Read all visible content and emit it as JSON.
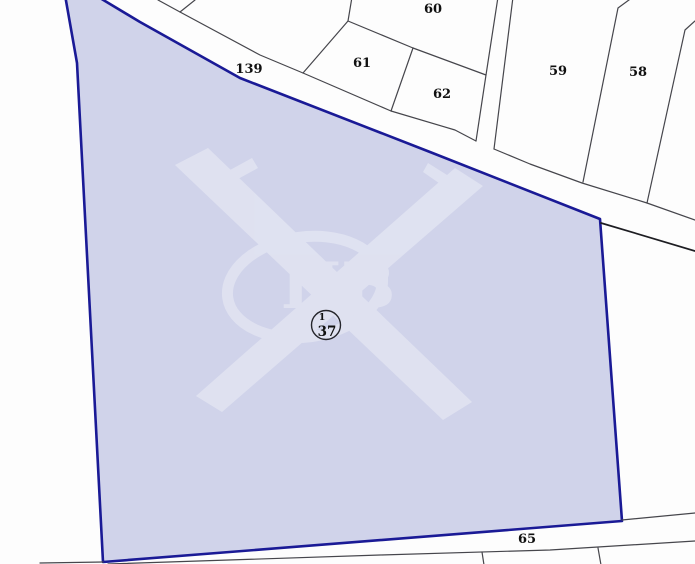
{
  "map": {
    "width": 695,
    "height": 564,
    "colors": {
      "background": "#fdfdfd",
      "parcel_fill": "#d0d3ea",
      "parcel_stroke": "#1a1a96",
      "boundary_line": "#46464c",
      "road_line": "#1d1d22",
      "label_text": "#111111",
      "circle_stroke": "#26262c",
      "watermark": "#eceef6"
    },
    "selected_parcel": {
      "number": "37",
      "superscript": "1",
      "circle_x": 326,
      "circle_y": 325,
      "polygon": [
        [
          65,
          -5
        ],
        [
          95,
          -5
        ],
        [
          140,
          22
        ],
        [
          240,
          78
        ],
        [
          430,
          152
        ],
        [
          600,
          219
        ],
        [
          613,
          398
        ],
        [
          622,
          521
        ],
        [
          103,
          562
        ],
        [
          77,
          63
        ]
      ]
    },
    "watermark_text": "НВ",
    "labels": [
      {
        "text": "60",
        "x": 433,
        "y": 13
      },
      {
        "text": "139",
        "x": 249,
        "y": 73
      },
      {
        "text": "61",
        "x": 362,
        "y": 67
      },
      {
        "text": "62",
        "x": 442,
        "y": 98
      },
      {
        "text": "59",
        "x": 558,
        "y": 75
      },
      {
        "text": "58",
        "x": 638,
        "y": 76
      },
      {
        "text": "65",
        "x": 527,
        "y": 543
      }
    ],
    "boundary_lines": [
      {
        "name": "road-139-upper-edge-line",
        "kind": "normal",
        "points": [
          [
            158,
            0
          ],
          [
            180,
            12
          ],
          [
            260,
            55
          ],
          [
            303,
            73
          ],
          [
            391,
            111
          ],
          [
            455,
            130
          ],
          [
            476,
            141
          ]
        ]
      },
      {
        "name": "top-left-parcel-split-line",
        "kind": "normal",
        "points": [
          [
            180,
            12
          ],
          [
            195,
            0
          ]
        ]
      },
      {
        "name": "parcel-61-left-edge-line",
        "kind": "normal",
        "points": [
          [
            303,
            73
          ],
          [
            348,
            21
          ],
          [
            352,
            -3
          ]
        ]
      },
      {
        "name": "parcel-60-61-boundary-line",
        "kind": "normal",
        "points": [
          [
            348,
            21
          ],
          [
            413,
            48
          ]
        ]
      },
      {
        "name": "parcel-61-62-boundary-line",
        "kind": "normal",
        "points": [
          [
            413,
            48
          ],
          [
            391,
            111
          ]
        ]
      },
      {
        "name": "parcel-60-62-boundary-line",
        "kind": "normal",
        "points": [
          [
            413,
            48
          ],
          [
            486,
            75
          ]
        ]
      },
      {
        "name": "path-strip-left-edge-line",
        "kind": "normal",
        "points": [
          [
            498,
            -3
          ],
          [
            486,
            75
          ],
          [
            476,
            141
          ]
        ]
      },
      {
        "name": "path-strip-right-edge-line",
        "kind": "normal",
        "points": [
          [
            513,
            -3
          ],
          [
            494,
            149
          ]
        ]
      },
      {
        "name": "road-edge-under-59-58-line",
        "kind": "normal",
        "points": [
          [
            494,
            149
          ],
          [
            530,
            164
          ],
          [
            582,
            183
          ],
          [
            647,
            203
          ],
          [
            695,
            220
          ]
        ]
      },
      {
        "name": "parcel-58-left-edge-line",
        "kind": "normal",
        "points": [
          [
            583,
            182
          ],
          [
            618,
            8
          ],
          [
            633,
            -3
          ]
        ]
      },
      {
        "name": "parcel-58-right-edge-line",
        "kind": "normal",
        "points": [
          [
            647,
            203
          ],
          [
            685,
            30
          ],
          [
            695,
            21
          ]
        ]
      },
      {
        "name": "road-lower-edge-right-line",
        "kind": "dark",
        "points": [
          [
            601,
            223
          ],
          [
            695,
            251
          ]
        ]
      },
      {
        "name": "road-65-upper-edge-right-line",
        "kind": "normal",
        "points": [
          [
            622,
            520
          ],
          [
            695,
            513
          ]
        ]
      },
      {
        "name": "road-65-lower-edge-line",
        "kind": "normal",
        "points": [
          [
            108,
            564
          ],
          [
            380,
            555
          ],
          [
            550,
            550
          ],
          [
            695,
            541
          ]
        ]
      },
      {
        "name": "road-65-lower-edge-left-line",
        "kind": "normal",
        "points": [
          [
            40,
            563
          ],
          [
            103,
            562
          ]
        ]
      },
      {
        "name": "parcel-split-below-65-line-1",
        "kind": "normal",
        "points": [
          [
            482,
            552
          ],
          [
            484,
            565
          ]
        ]
      },
      {
        "name": "parcel-split-below-65-line-2",
        "kind": "normal",
        "points": [
          [
            598,
            548
          ],
          [
            601,
            565
          ]
        ]
      }
    ]
  }
}
